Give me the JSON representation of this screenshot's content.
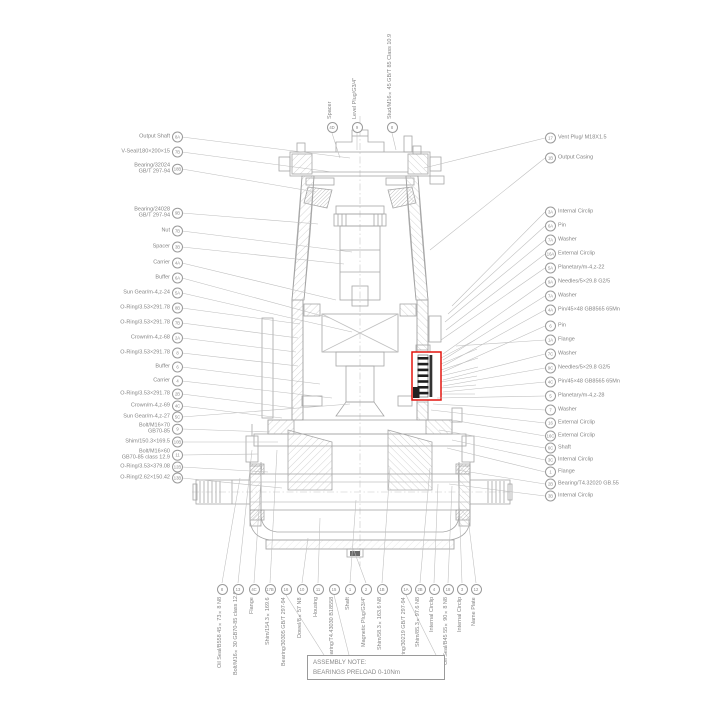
{
  "colors": {
    "highlight": "#e3150f",
    "line": "#a6a6a6",
    "text": "#858585"
  },
  "note": {
    "line1": "ASSEMBLY NOTE:",
    "line2": "BEARINGS PRELOAD 0-10Nm"
  },
  "labels": {
    "left": [
      {
        "id": "8A",
        "text": "Output Shaft"
      },
      {
        "id": "7B",
        "text": "V-Seal/180×200×15"
      },
      {
        "id": "18B",
        "text": "Bearing/32024\nGB/T 297-94"
      },
      {
        "id": "9B",
        "text": "Bearing/24028\nGB/T 297-94"
      },
      {
        "id": "7B",
        "text": "Nut"
      },
      {
        "id": "3B",
        "text": "Spacer"
      },
      {
        "id": "4A",
        "text": "Carrier"
      },
      {
        "id": "6A",
        "text": "Buffer"
      },
      {
        "id": "5A",
        "text": "Sun Gear/m-4,z-24"
      },
      {
        "id": "8B",
        "text": "O-Ring/3.53×291.78"
      },
      {
        "id": "7B",
        "text": "O-Ring/3.53×291.78"
      },
      {
        "id": "2A",
        "text": "Crown/m-4,z-68"
      },
      {
        "id": "8",
        "text": "O-Ring/3.53×291.78"
      },
      {
        "id": "6",
        "text": "Buffer"
      },
      {
        "id": "4",
        "text": "Carrier"
      },
      {
        "id": "2B",
        "text": "O-Ring/3.53×291.78"
      },
      {
        "id": "4C",
        "text": "Crown/m-4,z-69"
      },
      {
        "id": "5C",
        "text": "Sun Gear/m-4,z-27"
      },
      {
        "id": "9",
        "text": "Bolt/M16×70\nGB70-85"
      },
      {
        "id": "10B",
        "text": "Shim/150.3×169.5"
      },
      {
        "id": "11",
        "text": "Bolt/M16×60\nGB70-85 class 12.9"
      },
      {
        "id": "12B",
        "text": "O-Ring/3.53×379.08"
      },
      {
        "id": "13B",
        "text": "O-Ring/2.62×150.42"
      }
    ],
    "right": [
      {
        "id": "3A",
        "text": "Internal Circlip"
      },
      {
        "id": "6A",
        "text": "Pin"
      },
      {
        "id": "7A",
        "text": "Washer"
      },
      {
        "id": "16A",
        "text": "External Circlip"
      },
      {
        "id": "5A",
        "text": "Planetary/m-4,z-22"
      },
      {
        "id": "9A",
        "text": "Needles/5×29.8  G2/5"
      },
      {
        "id": "7A",
        "text": "Washer"
      },
      {
        "id": "4A",
        "text": "Pin/45×48 GB8565 65Mn"
      },
      {
        "id": "6",
        "text": "Pin"
      },
      {
        "id": "1A",
        "text": "Flange"
      },
      {
        "id": "7C",
        "text": "Washer"
      },
      {
        "id": "9C",
        "text": "Needles/5×29.8  G2/5"
      },
      {
        "id": "4C",
        "text": "Pin/45×48 GB8565 65Mn"
      },
      {
        "id": "5",
        "text": "Planetary/m-4,z-28"
      },
      {
        "id": "7",
        "text": "Washer"
      },
      {
        "id": "16",
        "text": "External Circlip"
      },
      {
        "id": "16C",
        "text": "External Circlip"
      },
      {
        "id": "6C",
        "text": "Shaft"
      },
      {
        "id": "3C",
        "text": "Internal Circlip"
      },
      {
        "id": "1",
        "text": "Flange"
      },
      {
        "id": "2B",
        "text": "Bearing/T4.32020 GB.55"
      },
      {
        "id": "3B",
        "text": "Internal Circlip"
      }
    ],
    "top": [
      {
        "id": "4D",
        "text": "Spacer"
      },
      {
        "id": "9",
        "text": "Level Plug/G3/4\""
      },
      {
        "id": "8",
        "text": "Stud/M16×45 GB/T 85 Class 10.9"
      }
    ],
    "top_right": [
      {
        "id": "17",
        "text": "Vent Plug/ M18X1.5"
      },
      {
        "id": "1B",
        "text": "Output Casing"
      }
    ],
    "bottom": [
      {
        "id": "8",
        "text": "Oil Seal/B558  45×73×8 N8"
      },
      {
        "id": "13",
        "text": "Bolt/M16×30 GB70-85 class 12.9"
      },
      {
        "id": "4C",
        "text": "Flange"
      },
      {
        "id": "17B",
        "text": "Shim/154.3×169.6"
      },
      {
        "id": "16",
        "text": "Bearing/30305 GB/T 297-94"
      },
      {
        "id": "10",
        "text": "Dowel/8×57 N8"
      },
      {
        "id": "11",
        "text": "Housing"
      },
      {
        "id": "15",
        "text": "Bearing/T4.43030 B18558"
      },
      {
        "id": "1",
        "text": "Shaft"
      },
      {
        "id": "2",
        "text": "Magnetic Plug/G3/4\""
      },
      {
        "id": "1B",
        "text": "Shim/58.3×163.6 N8"
      },
      {
        "id": "1A",
        "text": "Bearing/30219 GB/T 297-94"
      },
      {
        "id": "2B",
        "text": "Shim/85.3×97.6 N8"
      },
      {
        "id": "4",
        "text": "Internal Circlip"
      },
      {
        "id": "18",
        "text": "Oil Seal/B45  55×90×8 N8"
      },
      {
        "id": "3",
        "text": "Internal Circlip"
      },
      {
        "id": "12",
        "text": "Name Plate"
      }
    ]
  }
}
